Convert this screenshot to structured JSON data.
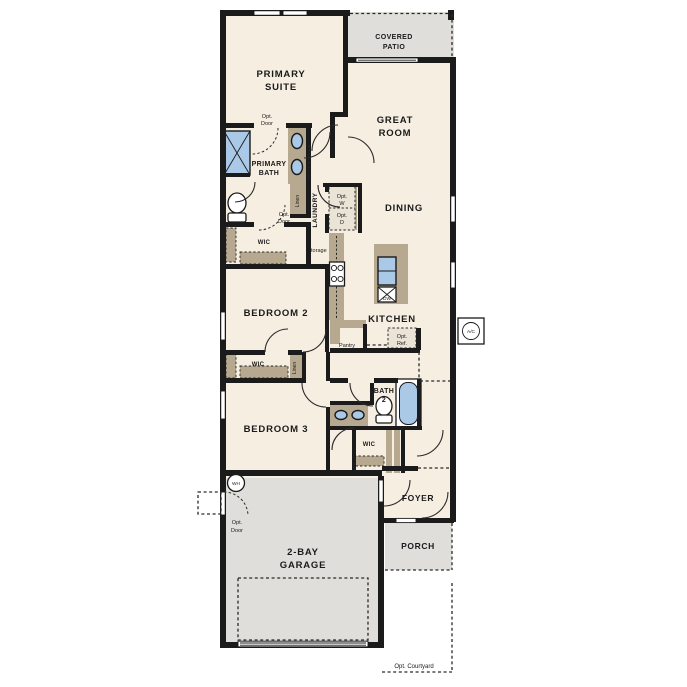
{
  "plan": {
    "rooms": {
      "covered_patio": {
        "l1": "COVERED",
        "l2": "PATIO"
      },
      "primary_suite": {
        "l1": "PRIMARY",
        "l2": "SUITE"
      },
      "great_room": {
        "l1": "GREAT",
        "l2": "ROOM"
      },
      "dining": "DINING",
      "primary_bath": {
        "l1": "PRIMARY",
        "l2": "BATH"
      },
      "laundry": "LAUNDRY",
      "bedroom2": "BEDROOM 2",
      "bedroom3": "BEDROOM 3",
      "kitchen": "KITCHEN",
      "pantry": "Pantry",
      "bath2": {
        "l1": "BATH",
        "l2": "2"
      },
      "wic": "WIC",
      "linen": "Linen",
      "storage": "Storage",
      "foyer": "FOYER",
      "porch": "PORCH",
      "garage": {
        "l1": "2-BAY",
        "l2": "GARAGE"
      }
    },
    "options": {
      "opt_door": {
        "l1": "Opt.",
        "l2": "Door"
      },
      "opt_washer": {
        "l1": "Opt.",
        "l2": "W"
      },
      "opt_dryer": {
        "l1": "Opt.",
        "l2": "D"
      },
      "opt_ref": {
        "l1": "Opt.",
        "l2": "Ref."
      },
      "opt_courtyard": "Opt. Courtyard"
    },
    "equipment": {
      "water_heater": "WH",
      "ac_unit": "A/C",
      "dishwasher": "DW"
    },
    "colors": {
      "wall": "#1b1b1b",
      "interior": "#f5eee1",
      "outdoor": "#e0dedb",
      "cabinet": "#b7a890",
      "cabinet_light": "#eae4d6",
      "fixture": "#a9c9e7",
      "line": "#2a2a2a"
    }
  }
}
